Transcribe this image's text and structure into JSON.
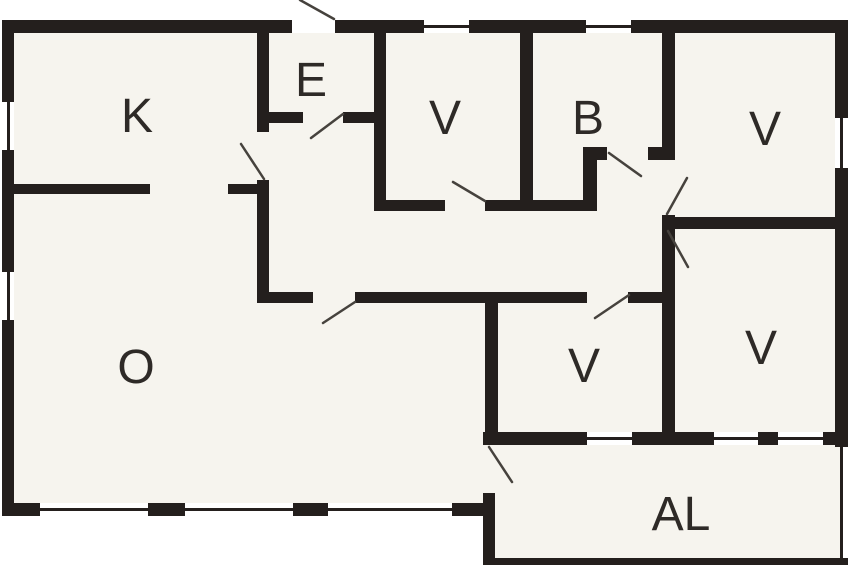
{
  "plan": {
    "kind": "floor-plan",
    "canvas": {
      "width": 848,
      "height": 565
    },
    "colors": {
      "wall": "#241f1d",
      "floor": "#f6f4ee",
      "outside": "#ffffff",
      "door_line": "#46423d",
      "label": "#2e2a27"
    },
    "rooms": [
      {
        "id": "k",
        "label": "K",
        "cx": 137,
        "cy": 117
      },
      {
        "id": "e",
        "label": "E",
        "cx": 311,
        "cy": 81
      },
      {
        "id": "v1",
        "label": "V",
        "cx": 445,
        "cy": 119
      },
      {
        "id": "b",
        "label": "B",
        "cx": 588,
        "cy": 119
      },
      {
        "id": "v2",
        "label": "V",
        "cx": 765,
        "cy": 130
      },
      {
        "id": "o",
        "label": "O",
        "cx": 136,
        "cy": 368
      },
      {
        "id": "v3",
        "label": "V",
        "cx": 584,
        "cy": 367
      },
      {
        "id": "v4",
        "label": "V",
        "cx": 761,
        "cy": 349
      },
      {
        "id": "al",
        "label": "AL",
        "cx": 681,
        "cy": 515
      }
    ],
    "floors": [
      {
        "id": "main-floor",
        "x": 14,
        "y": 33,
        "w": 821,
        "h": 471
      },
      {
        "id": "annex-floor",
        "x": 495,
        "y": 445,
        "w": 345,
        "h": 113
      }
    ],
    "walls": [
      {
        "id": "top-wall-left",
        "x": 2,
        "y": 20,
        "w": 290,
        "h": 13
      },
      {
        "id": "top-wall-right",
        "x": 335,
        "y": 20,
        "w": 513,
        "h": 13
      },
      {
        "id": "left-wall",
        "x": 2,
        "y": 20,
        "w": 12,
        "h": 496
      },
      {
        "id": "right-wall",
        "x": 835,
        "y": 20,
        "w": 13,
        "h": 427
      },
      {
        "id": "bottom-wall-main",
        "x": 2,
        "y": 503,
        "w": 481,
        "h": 13
      },
      {
        "id": "vrooms-bottom-wall",
        "x": 483,
        "y": 432,
        "w": 365,
        "h": 13
      },
      {
        "id": "annex-left-wall",
        "x": 483,
        "y": 493,
        "w": 12,
        "h": 72
      },
      {
        "id": "annex-bottom-wall",
        "x": 483,
        "y": 558,
        "w": 365,
        "h": 7
      },
      {
        "id": "annex-right-wall",
        "x": 840,
        "y": 445,
        "w": 3,
        "h": 113
      },
      {
        "id": "k-right-wall-upper",
        "x": 257,
        "y": 33,
        "w": 12,
        "h": 99
      },
      {
        "id": "k-right-wall-lower",
        "x": 257,
        "y": 180,
        "w": 12,
        "h": 123
      },
      {
        "id": "k-o-divider-left",
        "x": 14,
        "y": 184,
        "w": 136,
        "h": 10
      },
      {
        "id": "k-o-divider-right",
        "x": 228,
        "y": 184,
        "w": 41,
        "h": 10
      },
      {
        "id": "e-bottom-wall-left",
        "x": 269,
        "y": 112,
        "w": 34,
        "h": 11
      },
      {
        "id": "e-bottom-wall-right",
        "x": 343,
        "y": 112,
        "w": 43,
        "h": 11
      },
      {
        "id": "e-right-wall",
        "x": 374,
        "y": 33,
        "w": 12,
        "h": 178
      },
      {
        "id": "hall-top-wall-left",
        "x": 386,
        "y": 200,
        "w": 59,
        "h": 11
      },
      {
        "id": "hall-top-wall-right",
        "x": 485,
        "y": 200,
        "w": 48,
        "h": 11
      },
      {
        "id": "v1-b-divider",
        "x": 520,
        "y": 33,
        "w": 13,
        "h": 178
      },
      {
        "id": "b-bottom-wall-left",
        "x": 533,
        "y": 200,
        "w": 50,
        "h": 11
      },
      {
        "id": "b-step-wall",
        "x": 583,
        "y": 147,
        "w": 14,
        "h": 64
      },
      {
        "id": "b-bottom-wall-mid",
        "x": 597,
        "y": 147,
        "w": 10,
        "h": 13
      },
      {
        "id": "b-bottom-wall-right",
        "x": 648,
        "y": 147,
        "w": 27,
        "h": 13
      },
      {
        "id": "b-right-wall",
        "x": 662,
        "y": 33,
        "w": 13,
        "h": 125
      },
      {
        "id": "v2-door-post",
        "x": 662,
        "y": 215,
        "w": 13,
        "h": 16
      },
      {
        "id": "v2-v4-divider",
        "x": 675,
        "y": 217,
        "w": 160,
        "h": 12
      },
      {
        "id": "hall-bottom-wall-1",
        "x": 257,
        "y": 292,
        "w": 56,
        "h": 11
      },
      {
        "id": "hall-bottom-wall-2",
        "x": 355,
        "y": 292,
        "w": 232,
        "h": 11
      },
      {
        "id": "hall-bottom-wall-3",
        "x": 628,
        "y": 292,
        "w": 47,
        "h": 11
      },
      {
        "id": "o-v3-divider",
        "x": 485,
        "y": 303,
        "w": 13,
        "h": 129
      },
      {
        "id": "v3-v4-divider",
        "x": 662,
        "y": 231,
        "w": 13,
        "h": 201
      }
    ],
    "windows": [
      {
        "id": "window-left-k",
        "x": 2,
        "y": 102,
        "w": 12,
        "h": 48,
        "orient": "v"
      },
      {
        "id": "window-left-o",
        "x": 2,
        "y": 272,
        "w": 12,
        "h": 48,
        "orient": "v"
      },
      {
        "id": "window-top-v1",
        "x": 424,
        "y": 20,
        "w": 45,
        "h": 13,
        "orient": "h"
      },
      {
        "id": "window-top-b",
        "x": 586,
        "y": 20,
        "w": 45,
        "h": 13,
        "orient": "h"
      },
      {
        "id": "window-right-v2",
        "x": 835,
        "y": 118,
        "w": 13,
        "h": 50,
        "orient": "v"
      },
      {
        "id": "window-bottom-o1",
        "x": 40,
        "y": 503,
        "w": 108,
        "h": 13,
        "orient": "h"
      },
      {
        "id": "window-bottom-o2",
        "x": 185,
        "y": 503,
        "w": 108,
        "h": 13,
        "orient": "h"
      },
      {
        "id": "window-bottom-o3",
        "x": 328,
        "y": 503,
        "w": 124,
        "h": 13,
        "orient": "h"
      },
      {
        "id": "window-v3-bottom",
        "x": 587,
        "y": 432,
        "w": 45,
        "h": 13,
        "orient": "h"
      },
      {
        "id": "window-v4-bottom-1",
        "x": 714,
        "y": 432,
        "w": 44,
        "h": 13,
        "orient": "h"
      },
      {
        "id": "window-v4-bottom-2",
        "x": 778,
        "y": 432,
        "w": 45,
        "h": 13,
        "orient": "h"
      }
    ],
    "doors": [
      {
        "id": "entrance-door-swing",
        "x1": 300,
        "y1": 0,
        "x2": 334,
        "y2": 19
      },
      {
        "id": "e-door-swing",
        "x1": 343,
        "y1": 114,
        "x2": 311,
        "y2": 138
      },
      {
        "id": "k-door-swing",
        "x1": 264,
        "y1": 179,
        "x2": 241,
        "y2": 144
      },
      {
        "id": "v1-door-swing",
        "x1": 453,
        "y1": 182,
        "x2": 485,
        "y2": 201
      },
      {
        "id": "b-door-swing",
        "x1": 609,
        "y1": 153,
        "x2": 641,
        "y2": 176
      },
      {
        "id": "v2-door-swing",
        "x1": 687,
        "y1": 178,
        "x2": 667,
        "y2": 214
      },
      {
        "id": "v4-door-swing",
        "x1": 668,
        "y1": 231,
        "x2": 688,
        "y2": 267
      },
      {
        "id": "o-door-swing",
        "x1": 355,
        "y1": 302,
        "x2": 323,
        "y2": 323
      },
      {
        "id": "v3-door-swing",
        "x1": 629,
        "y1": 295,
        "x2": 595,
        "y2": 318
      },
      {
        "id": "al-door-swing",
        "x1": 489,
        "y1": 447,
        "x2": 512,
        "y2": 482
      }
    ]
  }
}
